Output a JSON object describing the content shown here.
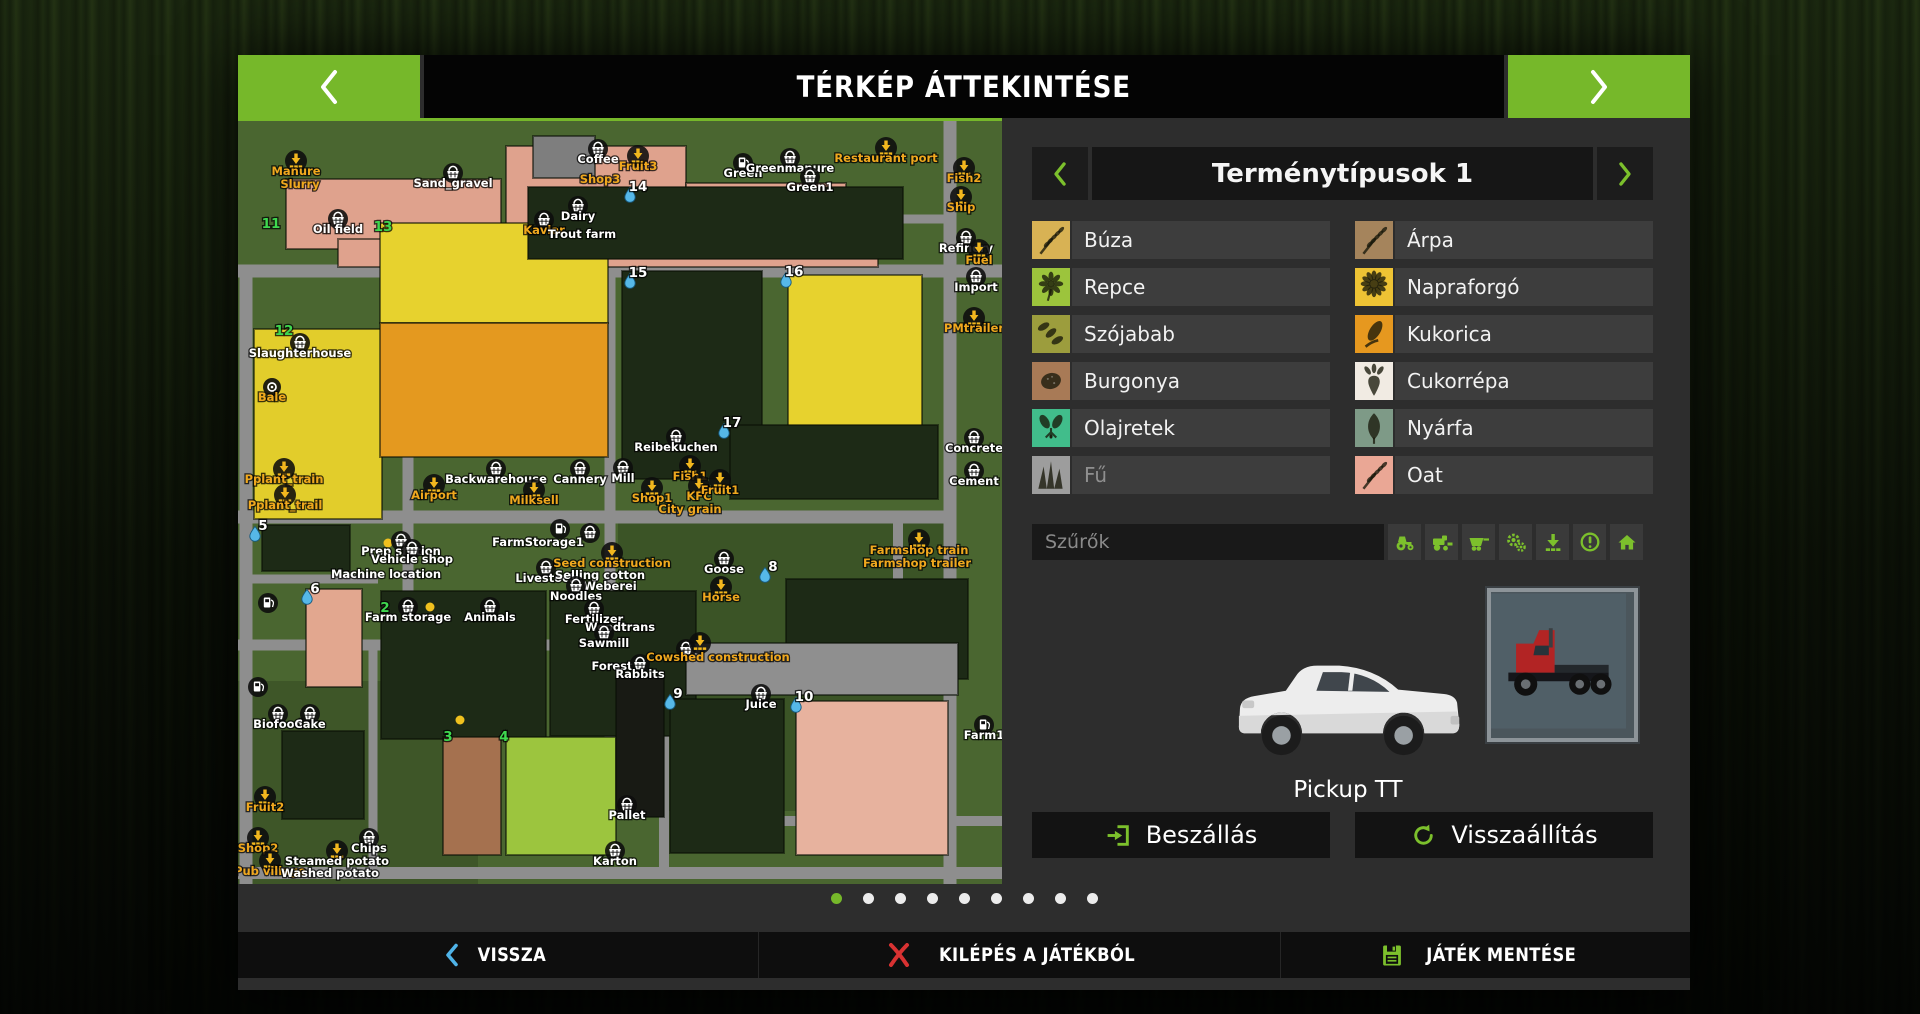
{
  "header": {
    "title": "TÉRKÉP ÁTTEKINTÉSE"
  },
  "panel": {
    "title": "Terménytípusok 1",
    "crops_left": [
      {
        "name": "Búza",
        "color": "#d8b254",
        "icon": "spike",
        "disabled": false
      },
      {
        "name": "Repce",
        "color": "#9cc43c",
        "icon": "flower",
        "disabled": false
      },
      {
        "name": "Szójabab",
        "color": "#9c9d3d",
        "icon": "pods",
        "disabled": false
      },
      {
        "name": "Burgonya",
        "color": "#a87a56",
        "icon": "blob",
        "disabled": false
      },
      {
        "name": "Olajretek",
        "color": "#41bd8b",
        "icon": "radish",
        "disabled": false
      },
      {
        "name": "Fű",
        "color": "#9d9d9d",
        "icon": "grass",
        "disabled": true
      }
    ],
    "crops_right": [
      {
        "name": "Árpa",
        "color": "#a5845c",
        "icon": "spike",
        "disabled": false
      },
      {
        "name": "Napraforgó",
        "color": "#eec334",
        "icon": "sunflower",
        "disabled": false
      },
      {
        "name": "Kukorica",
        "color": "#e6981f",
        "icon": "corn",
        "disabled": false
      },
      {
        "name": "Cukorrépa",
        "color": "#f1ebe3",
        "icon": "beet",
        "disabled": false
      },
      {
        "name": "Nyárfa",
        "color": "#7e9a87",
        "icon": "leaf",
        "disabled": false
      },
      {
        "name": "Oat",
        "color": "#eaa795",
        "icon": "spike",
        "disabled": false
      }
    ],
    "filter": {
      "placeholder": "Szűrők",
      "icons": [
        "tractor",
        "harvester",
        "trailer",
        "gears",
        "download",
        "warning",
        "home"
      ]
    },
    "vehicle": {
      "name": "Pickup TT"
    },
    "buttons": {
      "enter": "Beszállás",
      "reset": "Visszaállítás"
    }
  },
  "pager": {
    "total": 9,
    "active_index": 0
  },
  "footer": {
    "back": "VISSZA",
    "quit": "KILÉPÉS A JÁTÉKBÓL",
    "save": "JÁTÉK MENTÉSE"
  },
  "colors": {
    "accent": "#76b82a",
    "icon_green": "#7cc02c",
    "back_blue": "#4fb3e8",
    "quit_red": "#d83232",
    "label_orange": "#f0a81e",
    "label_white": "#ffffff",
    "field_number_green": "#3fd84f"
  },
  "map": {
    "width": 764,
    "height": 763,
    "background": "#4a6630",
    "road_color": "#8e8e8e",
    "fields": [
      {
        "x": 48,
        "y": 58,
        "w": 215,
        "h": 70,
        "f": "#dfa28d"
      },
      {
        "x": 268,
        "y": 25,
        "w": 180,
        "h": 102,
        "f": "#dfa28d"
      },
      {
        "x": 448,
        "y": 62,
        "w": 160,
        "h": 62,
        "f": "#dfa28d"
      },
      {
        "x": 100,
        "y": 118,
        "w": 540,
        "h": 28,
        "f": "#dfa28d"
      },
      {
        "x": 295,
        "y": 15,
        "w": 62,
        "h": 42,
        "f": "#7e7e7e"
      },
      {
        "x": 16,
        "y": 208,
        "w": 128,
        "h": 190,
        "f": "#e2cd2b"
      },
      {
        "x": 142,
        "y": 102,
        "w": 228,
        "h": 100,
        "f": "#e7d22e"
      },
      {
        "x": 142,
        "y": 202,
        "w": 228,
        "h": 134,
        "f": "#e4991f"
      },
      {
        "x": 290,
        "y": 66,
        "w": 375,
        "h": 72,
        "f": "#1d2a16"
      },
      {
        "x": 384,
        "y": 150,
        "w": 140,
        "h": 208,
        "f": "#1d2a16"
      },
      {
        "x": 550,
        "y": 154,
        "w": 134,
        "h": 204,
        "f": "#e7d22e"
      },
      {
        "x": 492,
        "y": 304,
        "w": 208,
        "h": 74,
        "f": "#1d2a16"
      },
      {
        "x": 24,
        "y": 404,
        "w": 88,
        "h": 46,
        "f": "#1d2a16"
      },
      {
        "x": 68,
        "y": 468,
        "w": 56,
        "h": 98,
        "f": "#e2a78f"
      },
      {
        "x": 143,
        "y": 470,
        "w": 165,
        "h": 148,
        "f": "#1d2a16"
      },
      {
        "x": 312,
        "y": 470,
        "w": 146,
        "h": 145,
        "f": "#1d2a16"
      },
      {
        "x": 548,
        "y": 458,
        "w": 182,
        "h": 100,
        "f": "#1d2a16"
      },
      {
        "x": 205,
        "y": 616,
        "w": 58,
        "h": 118,
        "f": "#a5714f"
      },
      {
        "x": 268,
        "y": 616,
        "w": 110,
        "h": 118,
        "f": "#9cc53e"
      },
      {
        "x": 432,
        "y": 578,
        "w": 114,
        "h": 154,
        "f": "#1d2a16"
      },
      {
        "x": 558,
        "y": 580,
        "w": 152,
        "h": 154,
        "f": "#e7b29e"
      },
      {
        "x": 44,
        "y": 610,
        "w": 82,
        "h": 88,
        "f": "#1d2a16"
      },
      {
        "x": 378,
        "y": 556,
        "w": 48,
        "h": 140,
        "f": "#181a14"
      },
      {
        "x": 448,
        "y": 522,
        "w": 272,
        "h": 52,
        "f": "#8f8f8f"
      }
    ],
    "roads": [
      [
        0,
        150,
        764,
        150,
        13
      ],
      [
        0,
        396,
        710,
        396,
        13
      ],
      [
        8,
        150,
        8,
        763,
        13
      ],
      [
        170,
        150,
        170,
        524,
        11
      ],
      [
        372,
        150,
        372,
        700,
        11
      ],
      [
        0,
        524,
        440,
        524,
        11
      ],
      [
        712,
        0,
        712,
        763,
        13
      ],
      [
        660,
        396,
        660,
        458,
        10
      ],
      [
        0,
        752,
        764,
        752,
        12
      ],
      [
        300,
        25,
        300,
        150,
        10
      ],
      [
        530,
        95,
        530,
        150,
        9
      ],
      [
        640,
        98,
        712,
        98,
        9
      ],
      [
        8,
        458,
        140,
        458,
        9
      ],
      [
        426,
        524,
        426,
        752,
        10
      ],
      [
        135,
        524,
        135,
        752,
        9
      ],
      [
        440,
        700,
        764,
        700,
        10
      ]
    ],
    "labels": [
      [
        "Manure",
        "o",
        58,
        54,
        "unload"
      ],
      [
        "Slurry",
        "o",
        62,
        67,
        ""
      ],
      [
        "Sand_gravel",
        "w",
        215,
        66,
        "basket"
      ],
      [
        "Coffee",
        "w",
        360,
        42,
        "basket"
      ],
      [
        "Fruit3",
        "o",
        400,
        49,
        "unload"
      ],
      [
        "Shop3",
        "o",
        362,
        62,
        ""
      ],
      [
        "Green",
        "w",
        505,
        56,
        "fuel"
      ],
      [
        "Greenmanure",
        "w",
        552,
        51,
        "basket"
      ],
      [
        "Green1",
        "w",
        572,
        70,
        "basket"
      ],
      [
        "Restaurant port",
        "o",
        648,
        41,
        "unload"
      ],
      [
        "Fish2",
        "o",
        726,
        61,
        "unload"
      ],
      [
        "Ship",
        "o",
        723,
        90,
        "unload"
      ],
      [
        "14",
        "n",
        400,
        70,
        "drop"
      ],
      [
        "11",
        "gn",
        33,
        107,
        ""
      ],
      [
        "13",
        "gn",
        145,
        110,
        ""
      ],
      [
        "Oil field",
        "w",
        100,
        112,
        "basket"
      ],
      [
        "Dairy",
        "w",
        340,
        99,
        "basket"
      ],
      [
        "Kaviar",
        "o",
        306,
        113,
        "basket"
      ],
      [
        "Trout farm",
        "w",
        344,
        117,
        ""
      ],
      [
        "Refinery",
        "w",
        728,
        131,
        "basket"
      ],
      [
        "Fuel",
        "o",
        741,
        143,
        "unload"
      ],
      [
        "Import",
        "w",
        738,
        170,
        "basket"
      ],
      [
        "PMtrailer",
        "o",
        736,
        211,
        "unload"
      ],
      [
        "15",
        "n",
        400,
        156,
        "drop"
      ],
      [
        "16",
        "n",
        556,
        155,
        "drop"
      ],
      [
        "12",
        "gn",
        46,
        214,
        ""
      ],
      [
        "Slaughterhouse",
        "w",
        62,
        236,
        "basket"
      ],
      [
        "Bale",
        "o",
        34,
        280,
        "cam"
      ],
      [
        "17",
        "n",
        494,
        306,
        "drop"
      ],
      [
        "Reibekuchen",
        "w",
        438,
        330,
        "basket"
      ],
      [
        "Concrete",
        "w",
        736,
        331,
        "basket"
      ],
      [
        "Cement",
        "w",
        736,
        364,
        "basket"
      ],
      [
        "Pplant_train",
        "o",
        46,
        362,
        "unload"
      ],
      [
        "Pplant_trail",
        "o",
        47,
        388,
        "unload"
      ],
      [
        "Airport",
        "o",
        196,
        378,
        "unload"
      ],
      [
        "Backwarehouse",
        "w",
        258,
        362,
        "basket"
      ],
      [
        "Milksell",
        "o",
        296,
        383,
        "unload"
      ],
      [
        "Cannery",
        "w",
        342,
        362,
        "basket"
      ],
      [
        "Mill",
        "w",
        385,
        361,
        "basket"
      ],
      [
        "Fish1",
        "o",
        452,
        359,
        "unload"
      ],
      [
        "Shop1",
        "o",
        414,
        381,
        "unload"
      ],
      [
        "KFC",
        "o",
        461,
        379,
        "unload"
      ],
      [
        "Fruit1",
        "o",
        482,
        373,
        "unload"
      ],
      [
        "City grain",
        "o",
        452,
        392,
        ""
      ],
      [
        "5",
        "n",
        25,
        409,
        "drop"
      ],
      [
        "6",
        "n",
        77,
        472,
        "drop"
      ],
      [
        "Prep station",
        "w",
        163,
        434,
        "basket"
      ],
      [
        "Vehicle shop",
        "w",
        174,
        442,
        "basket"
      ],
      [
        "Machine location",
        "w",
        148,
        457,
        ""
      ],
      [
        "2",
        "gn",
        147,
        491,
        ""
      ],
      [
        "Farm storage",
        "w",
        170,
        500,
        "basket"
      ],
      [
        "Animals",
        "w",
        252,
        500,
        "basket"
      ],
      [
        "FarmStorage1",
        "w",
        300,
        425,
        ""
      ],
      [
        "Livestock",
        "w",
        308,
        461,
        "basket"
      ],
      [
        "Seed construction",
        "o",
        374,
        446,
        "unload"
      ],
      [
        "Selling cotton",
        "w",
        362,
        458,
        ""
      ],
      [
        "Weberei",
        "w",
        372,
        469,
        ""
      ],
      [
        "Noodles",
        "w",
        338,
        479,
        "basket"
      ],
      [
        "Fertilizer",
        "w",
        356,
        502,
        "basket"
      ],
      [
        "Woodtrans",
        "w",
        382,
        510,
        ""
      ],
      [
        "Sawmill",
        "w",
        366,
        526,
        "basket"
      ],
      [
        "Forest",
        "w",
        374,
        549,
        ""
      ],
      [
        "Rabbits",
        "w",
        402,
        557,
        "basket"
      ],
      [
        "Goose",
        "w",
        486,
        452,
        "basket"
      ],
      [
        "Horse",
        "o",
        483,
        480,
        "unload"
      ],
      [
        "8",
        "n",
        535,
        450,
        "drop"
      ],
      [
        "Farmshop train",
        "o",
        681,
        433,
        "unload"
      ],
      [
        "Farmshop trailer",
        "o",
        679,
        446,
        ""
      ],
      [
        "Cowshed construction",
        "o",
        480,
        540,
        ""
      ],
      [
        "9",
        "n",
        440,
        577,
        "drop"
      ],
      [
        "Juice",
        "w",
        523,
        587,
        "basket"
      ],
      [
        "10",
        "n",
        566,
        580,
        "drop"
      ],
      [
        "Farm1",
        "w",
        746,
        618,
        "fuel"
      ],
      [
        "Biofood",
        "w",
        40,
        607,
        "basket"
      ],
      [
        "Cake",
        "w",
        72,
        607,
        "basket"
      ],
      [
        "3",
        "gn",
        210,
        620,
        ""
      ],
      [
        "4",
        "gn",
        266,
        620,
        ""
      ],
      [
        "Fruit2",
        "o",
        27,
        690,
        "unload"
      ],
      [
        "Shop2",
        "o",
        20,
        731,
        "unload"
      ],
      [
        "Pub village",
        "o",
        32,
        754,
        "unload"
      ],
      [
        "Chips",
        "w",
        131,
        731,
        "basket"
      ],
      [
        "Steamed potato",
        "w",
        99,
        744,
        "unload"
      ],
      [
        "Washed potato",
        "w",
        92,
        756,
        ""
      ],
      [
        "Pallet",
        "w",
        389,
        698,
        "basket"
      ],
      [
        "Karton",
        "w",
        377,
        744,
        "basket"
      ]
    ],
    "markers": [
      [
        "fuel",
        30,
        482
      ],
      [
        "fuel",
        20,
        566
      ],
      [
        "basket",
        352,
        412
      ],
      [
        "fuel",
        322,
        408
      ],
      [
        "dotG",
        168,
        427
      ],
      [
        "dotY",
        150,
        422
      ],
      [
        "dotY",
        192,
        486
      ],
      [
        "dotY",
        222,
        599
      ],
      [
        "basket",
        448,
        528
      ],
      [
        "unload",
        462,
        522
      ]
    ]
  }
}
